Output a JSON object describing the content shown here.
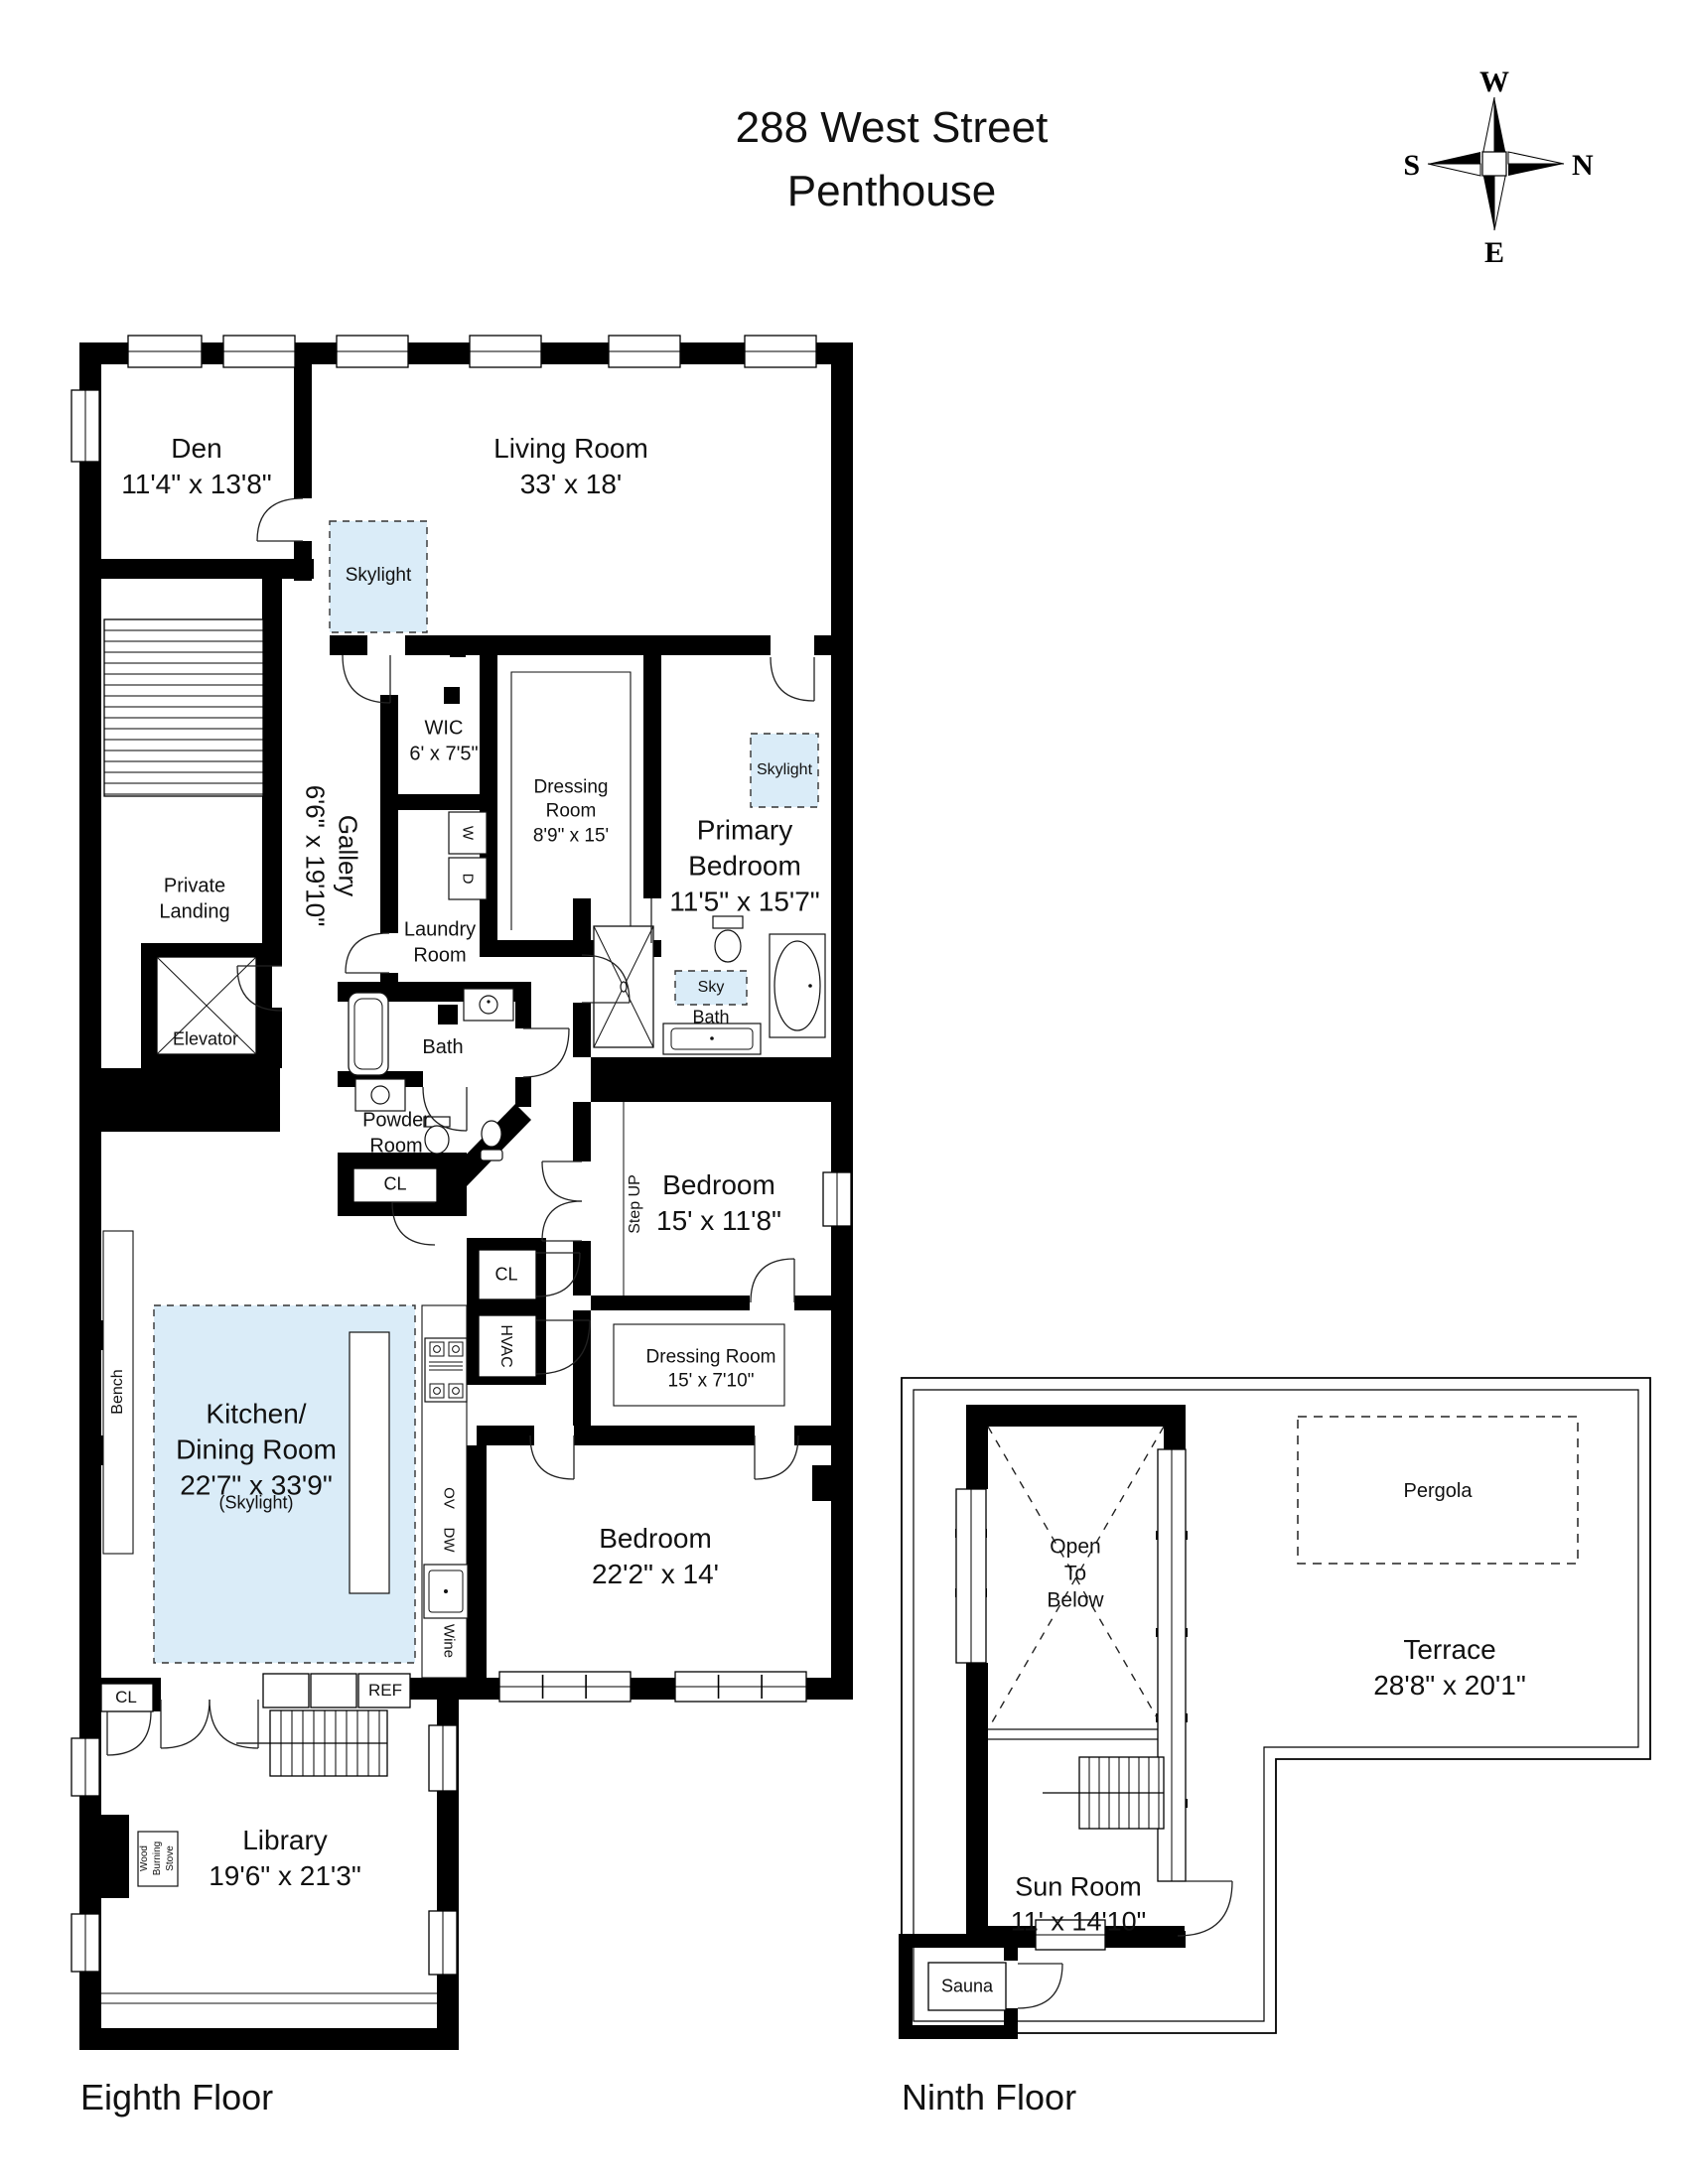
{
  "title": {
    "line1": "288 West Street",
    "line2": "Penthouse"
  },
  "compass": {
    "top": "W",
    "right": "N",
    "bottom": "E",
    "left": "S"
  },
  "eighth": {
    "caption": "Eighth Floor",
    "den": "Den",
    "den_dims": "11'4\" x 13'8\"",
    "living": "Living Room",
    "living_dims": "33' x 18'",
    "skylight": "Skylight",
    "sky_abbr": "Sky",
    "skylight_note": "(Skylight)",
    "gallery": "Gallery",
    "gallery_dims": "6'6\" x 19'10\"",
    "wic": "WIC",
    "wic_dims": "6' x 7'5\"",
    "washer": "W",
    "dryer": "D",
    "laundry_l1": "Laundry",
    "laundry_l2": "Room",
    "dressing1_l1": "Dressing",
    "dressing1_l2": "Room",
    "dressing1_dims": "8'9\" x 15'",
    "primary_l1": "Primary",
    "primary_l2": "Bedroom",
    "primary_dims": "11'5\" x 15'7\"",
    "private_l1": "Private",
    "private_l2": "Landing",
    "elevator": "Elevator",
    "bath": "Bath",
    "powder_l1": "Powder",
    "powder_l2": "Room",
    "cl": "CL",
    "bedroom1": "Bedroom",
    "bedroom1_dims": "15' x 11'8\"",
    "step_up": "Step UP",
    "hvac": "HVAC",
    "dressing2": "Dressing Room",
    "dressing2_dims": "15' x 7'10\"",
    "kitchen_l1": "Kitchen/",
    "kitchen_l2": "Dining Room",
    "kitchen_dims": "22'7\" x 33'9\"",
    "bench": "Bench",
    "ov": "OV",
    "dw": "DW",
    "wine": "Wine",
    "ref": "REF",
    "bedroom2": "Bedroom",
    "bedroom2_dims": "22'2\" x 14'",
    "library": "Library",
    "library_dims": "19'6\" x 21'3\"",
    "stove_l1": "Wood",
    "stove_l2": "Burning",
    "stove_l3": "Stove"
  },
  "ninth": {
    "caption": "Ninth Floor",
    "open_l1": "Open",
    "open_l2": "To",
    "open_l3": "Below",
    "pergola": "Pergola",
    "terrace": "Terrace",
    "terrace_dims": "28'8\" x 20'1\"",
    "sunroom": "Sun Room",
    "sunroom_dims": "11' x 14'10\"",
    "sauna": "Sauna"
  },
  "colors": {
    "wall": "#000000",
    "line": "#1a1a1a",
    "skylight_fill": "#daecf8"
  }
}
